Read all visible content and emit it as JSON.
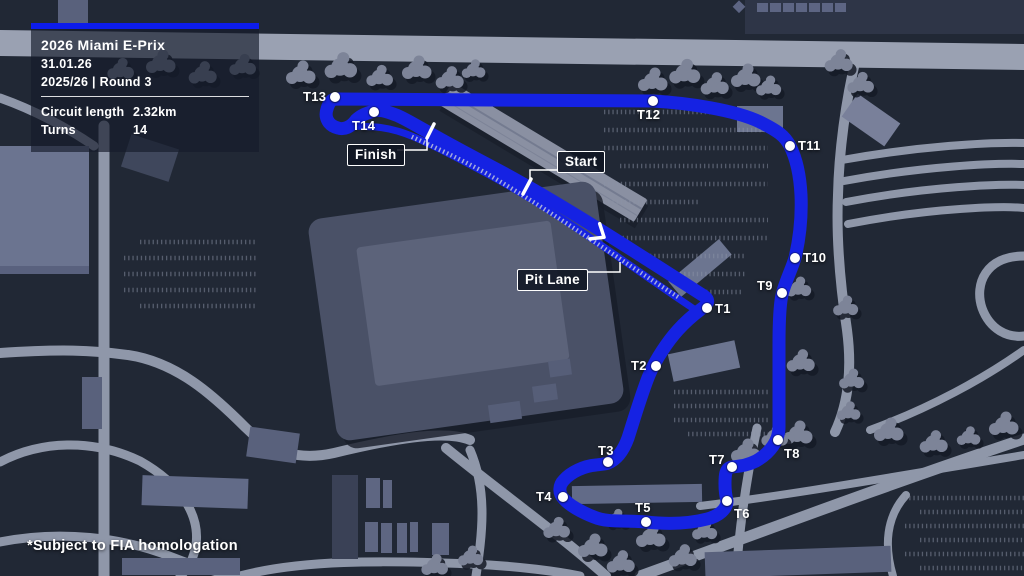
{
  "panel": {
    "title": "2026 Miami E-Prix",
    "date": "31.01.26",
    "season_round": "2025/26  |  Round 3",
    "stats": [
      {
        "label": "Circuit length",
        "value": "2.32km"
      },
      {
        "label": "Turns",
        "value": "14"
      }
    ]
  },
  "callouts": {
    "finish": "Finish",
    "start": "Start",
    "pit_lane": "Pit Lane"
  },
  "circuit": {
    "name": "2026 Miami E-Prix circuit",
    "turns": [
      {
        "id": "T1",
        "marker": {
          "x": 707,
          "y": 308
        },
        "label": {
          "x": 715,
          "y": 301
        }
      },
      {
        "id": "T2",
        "marker": {
          "x": 656,
          "y": 366
        },
        "label": {
          "x": 631,
          "y": 358
        }
      },
      {
        "id": "T3",
        "marker": {
          "x": 608,
          "y": 462
        },
        "label": {
          "x": 598,
          "y": 443
        }
      },
      {
        "id": "T4",
        "marker": {
          "x": 563,
          "y": 497
        },
        "label": {
          "x": 536,
          "y": 489
        }
      },
      {
        "id": "T5",
        "marker": {
          "x": 646,
          "y": 522
        },
        "label": {
          "x": 635,
          "y": 500
        }
      },
      {
        "id": "T6",
        "marker": {
          "x": 727,
          "y": 501
        },
        "label": {
          "x": 734,
          "y": 506
        }
      },
      {
        "id": "T7",
        "marker": {
          "x": 732,
          "y": 467
        },
        "label": {
          "x": 709,
          "y": 452
        }
      },
      {
        "id": "T8",
        "marker": {
          "x": 778,
          "y": 440
        },
        "label": {
          "x": 784,
          "y": 446
        }
      },
      {
        "id": "T9",
        "marker": {
          "x": 782,
          "y": 293
        },
        "label": {
          "x": 757,
          "y": 278
        }
      },
      {
        "id": "T10",
        "marker": {
          "x": 795,
          "y": 258
        },
        "label": {
          "x": 803,
          "y": 250
        }
      },
      {
        "id": "T11",
        "marker": {
          "x": 790,
          "y": 146
        },
        "label": {
          "x": 798,
          "y": 138
        }
      },
      {
        "id": "T12",
        "marker": {
          "x": 653,
          "y": 101
        },
        "label": {
          "x": 637,
          "y": 107
        }
      },
      {
        "id": "T13",
        "marker": {
          "x": 335,
          "y": 97
        },
        "label": {
          "x": 303,
          "y": 89
        }
      },
      {
        "id": "T14",
        "marker": {
          "x": 374,
          "y": 112
        },
        "label": {
          "x": 352,
          "y": 118
        }
      }
    ]
  },
  "footnote": "*Subject to FIA homologation",
  "colors": {
    "track_blue": "#1522e3",
    "accent_bar": "#0d1cea",
    "map_background": "#212835",
    "road_gray": "#8f97a9",
    "highway_gray": "#9aa1b2"
  }
}
